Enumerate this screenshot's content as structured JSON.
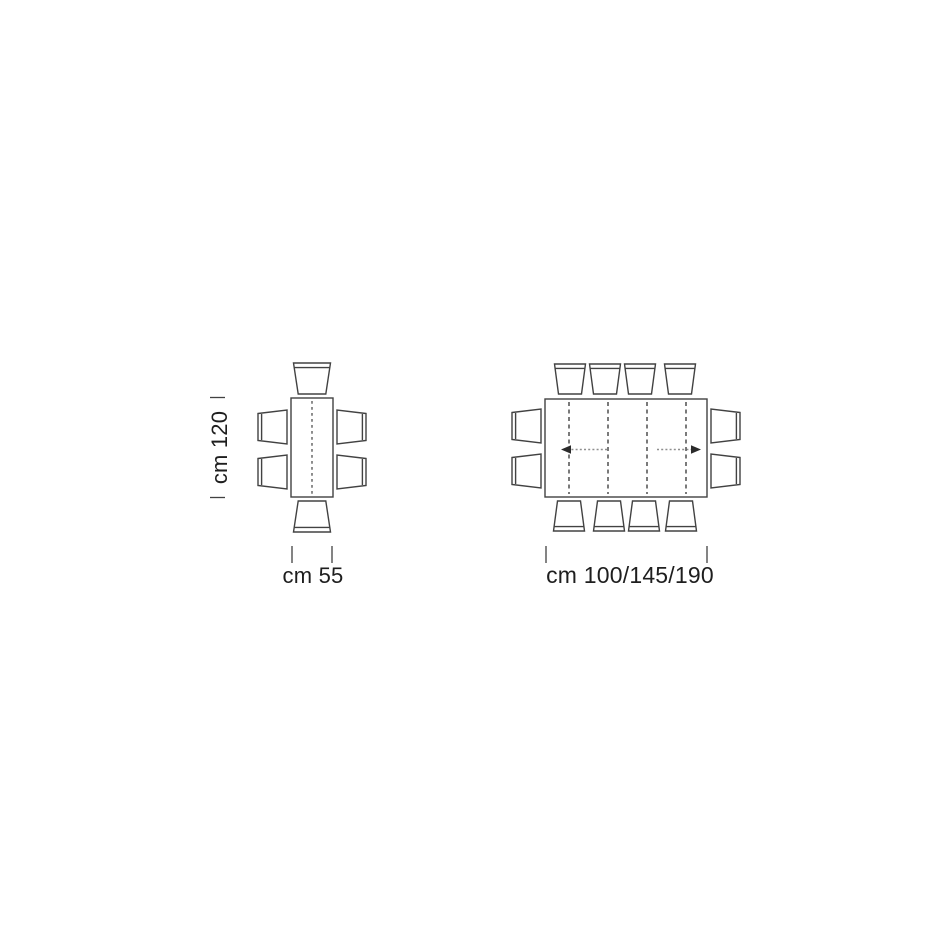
{
  "small_table_diagram": {
    "depth_label": "cm 120",
    "width_label": "cm 55",
    "seats": 6
  },
  "large_table_diagram": {
    "width_label": "cm 100/145/190",
    "seats": 10
  },
  "colors": {
    "line": "#424242",
    "text": "#1e1e1e",
    "dashed_extension": "#8f8f8f",
    "background": "#ffffff"
  }
}
